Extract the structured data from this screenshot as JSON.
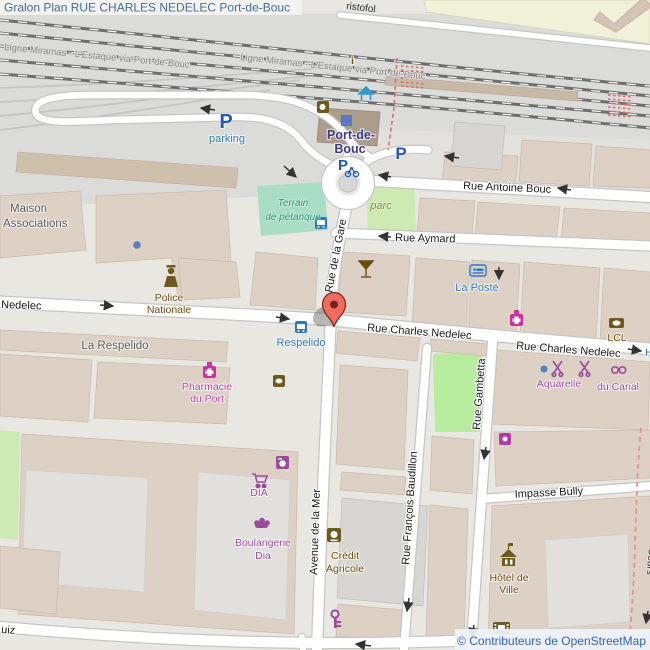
{
  "title": "Gralon Plan RUE CHARLES NEDELEC Port-de-Bouc",
  "attribution": "© Contributeurs de OpenStreetMap",
  "railway": {
    "line_label": "Ligne Miramas - L'Estaque via Port-de-Bouc"
  },
  "station": {
    "name_line1": "Port-de-",
    "name_line2": "Bouc"
  },
  "streets": {
    "cristofol_partial": "ristofol",
    "antoine_bouc": "Rue Antoine Bouc",
    "aymard": "Rue Aymard",
    "gare": "Rue de la Gare",
    "nedelec": "Rue Charles Nedelec",
    "nedelec_partial": "Nedelec",
    "nedelec_h_partial": "H",
    "gambetta": "Rue Gambetta",
    "avenue_mer": "Avenue de la Mer",
    "baudillon": "Rue François Baudillon",
    "impasse_bully": "Impasse Bully",
    "ruiz_partial": "uiz",
    "cours_partial": "Cours"
  },
  "labels": {
    "parking": "parking",
    "parking_p": "P",
    "petanque_line1": "Terrain",
    "petanque_line2": "de pétanque",
    "parc": "parc",
    "maison_line1": "Maison",
    "maison_line2": "Associations",
    "police_line1": "Police",
    "police_line2": "Nationale",
    "la_respelido": "La Respelido",
    "respelido_stop": "Respelido",
    "pharmacie_line1": "Pharmacie",
    "pharmacie_line2": "du Port",
    "la_poste": "La Poste",
    "dia": "DIA",
    "boulangerie_line1": "Boulangerie",
    "boulangerie_line2": "Dia",
    "credit_line1": "Crédit",
    "credit_line2": "Agricole",
    "lcl": "LCL",
    "aquarelle": "Aquarelle",
    "du_canal": "du Canal",
    "hotel_de_ville_line1": "Hôtel de",
    "hotel_de_ville_line2": "Ville",
    "info": "i"
  },
  "colors": {
    "marker_red": "#ef6b5e",
    "shop_purple": "#9c4a9c",
    "amenity_brown": "#734a08",
    "health_magenta": "#c9399e",
    "transport_blue": "#2e77c9",
    "station_navy": "#3b3b8c",
    "park_green": "#cdeab2",
    "pitch_green": "#aaddc6",
    "building_fill": "#ddd1c6",
    "title_blue": "#44709d",
    "link_blue": "#355fc0"
  }
}
